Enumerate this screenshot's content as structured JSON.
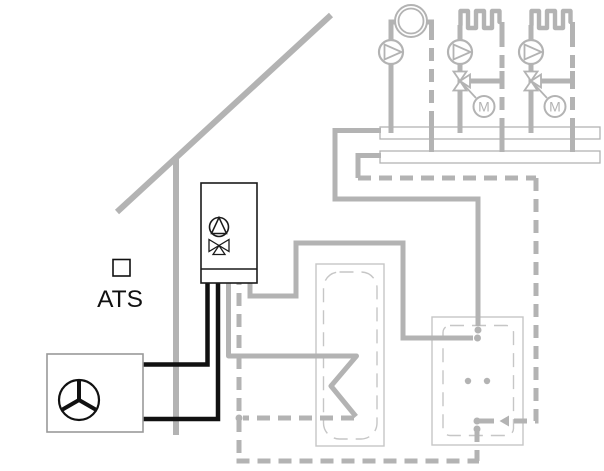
{
  "diagram": {
    "type": "heating-system-hydraulic-scheme",
    "labels": {
      "outdoor_sensor": "ATS",
      "mixer_motor_1": "M",
      "mixer_motor_2": "M"
    },
    "colors": {
      "pipe_gray": "#b3b3b3",
      "tank_outline": "#c6c6c6",
      "black": "#111111",
      "heat_pump_outline": "#999999",
      "background": "#ffffff"
    }
  }
}
